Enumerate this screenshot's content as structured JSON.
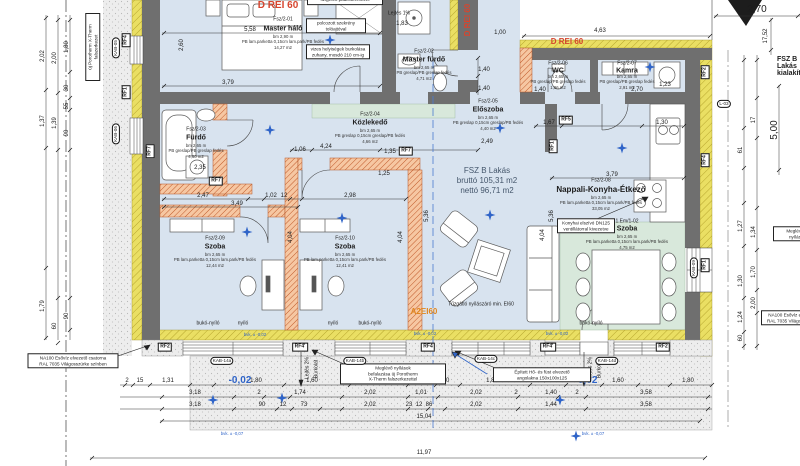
{
  "title": {
    "right_edge": "FSZ B Lakás\nkialakítása"
  },
  "apartment": {
    "name": "FSZ B Lakás",
    "gross": "bruttó 105,31 m2",
    "net": "nettó 96,71 m2"
  },
  "rooms": {
    "master_halo": {
      "code": "Fsz/2-01",
      "name": "Master háló",
      "info": "bm 2,90 m\nPB lam.parketta 0,15cm lam.park/PB fedés\n14,27 m2"
    },
    "master_furdo": {
      "code": "Fsz/2-02",
      "name": "Master fürdő",
      "info": "bm 2,65 m\nPB greslap/PB greslap fedés\n4,71 m2"
    },
    "furdo": {
      "code": "Fsz/2-03",
      "name": "Fürdő",
      "info": "bm 2,65 m\nPB greslap/PB greslap fedés\n4,60 m2"
    },
    "kozlekedo": {
      "code": "Fsz/2-04",
      "name": "Közlekedő",
      "info": "bm 2,65 m\nPB greslap 0,15cm greslap/PB fedés\n4,66 m2"
    },
    "eloszoba": {
      "code": "Fsz/2-05",
      "name": "Előszoba",
      "info": "bm 2,65 m\nPB greslap 0,15cm greslap/PB fedés\n4,40 m2"
    },
    "wc": {
      "code": "Fsz/2-06",
      "name": "WC",
      "info": "bm 2,65 m\nPB greslap/PB greslap fedés\n1,96 m2"
    },
    "kamra": {
      "code": "Fsz/2-07",
      "name": "Kamra",
      "info": "bm 2,65 m\nPB greslap/PB greslap fedés\n2,91 m2"
    },
    "nappali": {
      "code": "Fsz/2-08",
      "name": "Nappali-Konyha-Étkező",
      "info": "bm 2,65 m\nPB lam.parketta 0,15cm lam.park/PB fedés\n33,05 m2"
    },
    "szoba1": {
      "code": "Fsz/2-09",
      "name": "Szoba",
      "info": "bm 2,65 m\nPB lam.parketta 0,15cm lam.park/PB fedés\n12,44 m2"
    },
    "szoba2": {
      "code": "Fsz/2-10",
      "name": "Szoba",
      "info": "bm 2,65 m\nPB lam.parketta 0,15cm lam.park/PB fedés\n12,41 m2"
    },
    "szoba3": {
      "code": "1.Em/1-02",
      "name": "Szoba",
      "info": "bm 2,65 m\nPB lam.parketta 0,15cm lam.park/PB fedés\n4,75 m2"
    }
  },
  "fire": {
    "rei60": "D REI 60",
    "a2ei60": "A2EI60",
    "tuzgatlo": "Tűzgátló nyílászáró min. EI60"
  },
  "notes": {
    "befalazas": "Meglévő nyílások\nbefalazása új Porotherm\nX-Therm falszerkezettel",
    "angolakna": "Épített Hő- és füst elvezető\nangolakna 150x100x125",
    "esoviz": "NA100 Esővíz elvezető csatorna\nRAL 7035 Világosszürke színben",
    "porotherm": "új Porotherm X-Therm\nfalszerkezet",
    "konyhai": "Konyhai elszívó DN125\nventillátorral kivezetve",
    "szekreny": "polcozott szekrény\ntolóajtóval",
    "vizes": "vizes helyiségek burkolása\nzuhany, mosdó 210 cm-ig",
    "padlo": "szigetelt padlószerkezet",
    "megl_right": "Meglévő\nnyílás",
    "esoviz_right": "NA100 Esővíz elvezető\nRAL 7035 Világosszürke"
  },
  "slopes": {
    "lejtes1": "Lejtés 1%",
    "lejtes2": "Lejtés 2%",
    "burkolat": "Burkolat"
  },
  "levels": {
    "l002": "-0,02",
    "bvk02": "bvk. ± -0,02",
    "bvk07": "bvk. ± -0,07",
    "section": "A"
  },
  "window_types": {
    "buko": "bukó-nyíló",
    "nyilo": "nyíló"
  },
  "tags": {
    "rf1": "RF1",
    "rf2": "RF2",
    "rf4": "RF4",
    "rf4v": "RF4'",
    "rf5": "RF5",
    "rf7": "RF7",
    "l03": "L-03",
    "kab05": "KAB-05",
    "kab06": "KAB-06",
    "kab09": "KAB-09",
    "kab14a": "KAB-14a",
    "kab14b": "KAB-14b",
    "kab14c": "KAB-14c",
    "kab14d": "KAB-14d"
  },
  "dims": {
    "b1": [
      "2",
      "15",
      "1,31",
      "1,80",
      "1,60",
      "1,80",
      "30",
      "1,01",
      "30",
      "1,80",
      "1,26",
      "1,60",
      "1,80"
    ],
    "b2": [
      "3,18",
      "2",
      "1,74",
      "2,02",
      "1,01",
      "2,02",
      "2",
      "1,40",
      "2",
      "3,58"
    ],
    "b3": [
      "3,18",
      "90",
      "12",
      "73",
      "2,02",
      "23",
      "12",
      "86",
      "2,02",
      "1,44",
      "3,58"
    ],
    "b4": "15,04",
    "b5": "11,97",
    "l1": [
      "2,02",
      "1,37",
      "1,79"
    ],
    "l2": [
      "2,00",
      "1,39",
      "60"
    ],
    "l3": [
      "1,80",
      "30",
      "55",
      "90",
      "90"
    ],
    "r1": [
      "61",
      "1,27",
      "1,30",
      "1,24",
      "60"
    ],
    "r2": [
      "17",
      "1,34",
      "1,70",
      "2,00"
    ],
    "t1752": "17,52",
    "t500": "5,00",
    "t270": "2,70",
    "t463": "4,63",
    "in": [
      "5,58",
      "2,60",
      "3,79",
      "1,83",
      "1,00",
      "1,40",
      "1,40",
      "1,40",
      "1,23",
      "2,70",
      "1,67",
      "1,30",
      "4,24",
      "1,06",
      "1,35",
      "2,49",
      "2,35",
      "1,25",
      "3,79",
      "2,47",
      "1,02",
      "12",
      "2,98",
      "3,49",
      "4,04",
      "4,04",
      "4,04",
      "5,36",
      "5,36"
    ]
  }
}
